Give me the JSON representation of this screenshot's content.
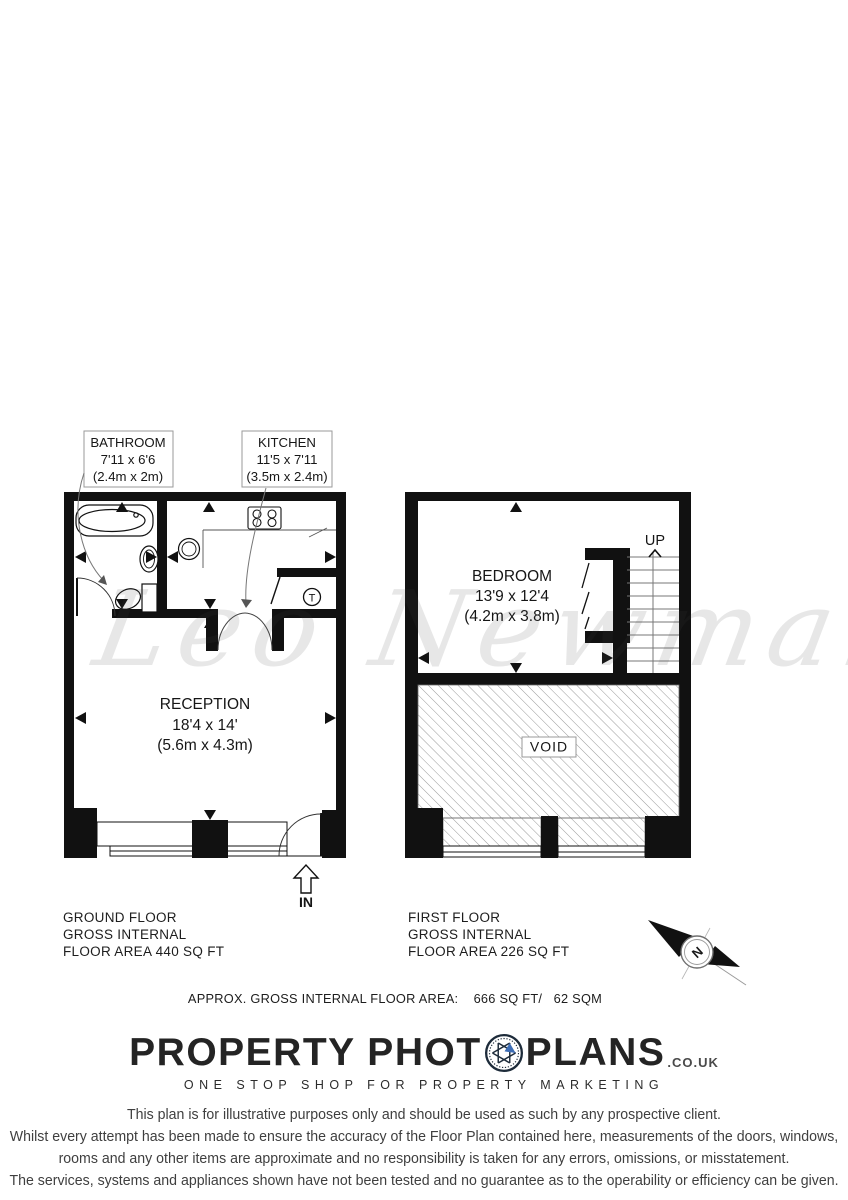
{
  "watermark": "Leo Newman",
  "ground_floor": {
    "labels": {
      "bathroom": {
        "name": "BATHROOM",
        "imperial": "7'11 x 6'6",
        "metric": "(2.4m x 2m)"
      },
      "kitchen": {
        "name": "KITCHEN",
        "imperial": "11'5 x 7'11",
        "metric": "(3.5m x 2.4m)"
      },
      "reception": {
        "name": "RECEPTION",
        "imperial": "18'4 x 14'",
        "metric": "(5.6m x 4.3m)"
      }
    },
    "appliance_t": "T",
    "entrance": "IN",
    "caption": {
      "line1": "GROUND FLOOR",
      "line2": "GROSS INTERNAL",
      "line3": "FLOOR AREA 440 SQ FT"
    }
  },
  "first_floor": {
    "labels": {
      "bedroom": {
        "name": "BEDROOM",
        "imperial": "13'9 x 12'4",
        "metric": "(4.2m x 3.8m)"
      },
      "void": "VOID",
      "stairs": "UP"
    },
    "caption": {
      "line1": "FIRST FLOOR",
      "line2": "GROSS INTERNAL",
      "line3": "FLOOR AREA 226 SQ FT"
    }
  },
  "summary": "APPROX. GROSS INTERNAL FLOOR AREA:    666 SQ FT/   62 SQM",
  "compass_n": "N",
  "logo": {
    "part1": "PROPERTY PHOT",
    "part2": "PLANS",
    "suffix": ".CO.UK",
    "tagline": "ONE STOP SHOP FOR PROPERTY MARKETING",
    "accent_color": "#3d6db5",
    "text_color": "#242424"
  },
  "disclaimer": {
    "line1": "This plan is for illustrative purposes only and should be used as such by any prospective client.",
    "line2": "Whilst every attempt has been made to ensure the accuracy of the Floor Plan contained here, measurements of the doors, windows,",
    "line3": "rooms and any other items are approximate and no responsibility is taken for any errors, omissions, or misstatement.",
    "line4": "The services, systems and appliances shown have not been tested and no guarantee as to the operability or efficiency can be given."
  }
}
